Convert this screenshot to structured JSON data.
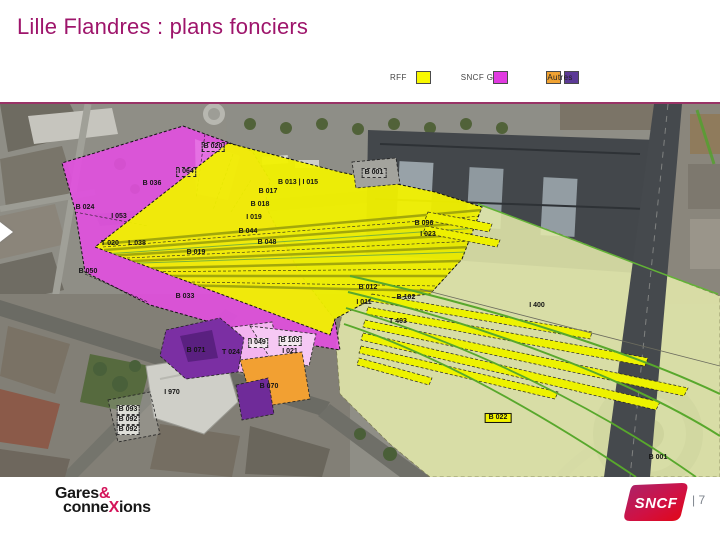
{
  "title": "Lille Flandres : plans fonciers",
  "title_color": "#9e156b",
  "legend": {
    "items": [
      {
        "key": "rff",
        "label": "RFF",
        "mode": 1,
        "swatches": [
          "#f8f800"
        ]
      },
      {
        "key": "sncf-gc",
        "label": "SNCF G&C",
        "mode": 2,
        "swatches": [
          "#e03ae0"
        ]
      },
      {
        "key": "autres",
        "label": "Autres",
        "mode": 3,
        "swatches": [
          "#f0a232",
          "#5c3a96"
        ]
      }
    ]
  },
  "map": {
    "description": "Aerial photo of Lille Flandres station area with land-ownership parcel overlay",
    "ownership_colors": {
      "rff_yellow": "#f1f100",
      "sncf_gc_magenta": "#e24fe0",
      "autres_orange": "#f2a032",
      "autres_purple": "#7b2fa3",
      "pale_rail_area": "#e3e8ab"
    },
    "parcel_labels": [
      {
        "text": "B 020",
        "x": 213,
        "y": 43,
        "box": "dashed"
      },
      {
        "text": "I 064",
        "x": 186,
        "y": 68,
        "box": "dashed"
      },
      {
        "text": "B 036",
        "x": 152,
        "y": 80
      },
      {
        "text": "B 024",
        "x": 85,
        "y": 104
      },
      {
        "text": "I 053",
        "x": 119,
        "y": 113
      },
      {
        "text": "B 013 | I 015",
        "x": 298,
        "y": 79
      },
      {
        "text": "B 017",
        "x": 268,
        "y": 88
      },
      {
        "text": "B 018",
        "x": 260,
        "y": 101
      },
      {
        "text": "I 019",
        "x": 254,
        "y": 114
      },
      {
        "text": "B 044",
        "x": 248,
        "y": 128
      },
      {
        "text": "B 048",
        "x": 267,
        "y": 139
      },
      {
        "text": "T 020",
        "x": 110,
        "y": 140
      },
      {
        "text": "L 038",
        "x": 137,
        "y": 140
      },
      {
        "text": "B 019",
        "x": 196,
        "y": 149
      },
      {
        "text": "B 050",
        "x": 88,
        "y": 168
      },
      {
        "text": "B 033",
        "x": 185,
        "y": 193
      },
      {
        "text": "B 001",
        "x": 374,
        "y": 69,
        "box": "gray"
      },
      {
        "text": "B 096",
        "x": 424,
        "y": 120
      },
      {
        "text": "I 023",
        "x": 428,
        "y": 131
      },
      {
        "text": "B 012",
        "x": 368,
        "y": 184
      },
      {
        "text": "B 102",
        "x": 406,
        "y": 194
      },
      {
        "text": "I 011",
        "x": 364,
        "y": 199
      },
      {
        "text": "T 403",
        "x": 398,
        "y": 218
      },
      {
        "text": "I 400",
        "x": 537,
        "y": 202
      },
      {
        "text": "B 022",
        "x": 498,
        "y": 314,
        "box": "yellow"
      },
      {
        "text": "B 001",
        "x": 658,
        "y": 354
      },
      {
        "text": "B 071",
        "x": 196,
        "y": 247
      },
      {
        "text": "T 024",
        "x": 231,
        "y": 249
      },
      {
        "text": "I 049",
        "x": 258,
        "y": 239,
        "box": "light"
      },
      {
        "text": "B 103",
        "x": 290,
        "y": 237,
        "box": "light"
      },
      {
        "text": "I 021",
        "x": 290,
        "y": 248
      },
      {
        "text": "B 070",
        "x": 269,
        "y": 283
      },
      {
        "text": "I 970",
        "x": 172,
        "y": 289
      },
      {
        "text": "B 093",
        "x": 128,
        "y": 306,
        "box": "light"
      },
      {
        "text": "B 092",
        "x": 128,
        "y": 316,
        "box": "light"
      },
      {
        "text": "B 092",
        "x": 128,
        "y": 326,
        "box": "light"
      }
    ]
  },
  "footer": {
    "gares_logo": {
      "part1": "Gares",
      "amp": "&",
      "part2": "conne",
      "x": "X",
      "part3": "ions"
    },
    "sncf_logo_text": "SNCF",
    "page_number": "| 7",
    "accent_red": "#d4145a"
  }
}
